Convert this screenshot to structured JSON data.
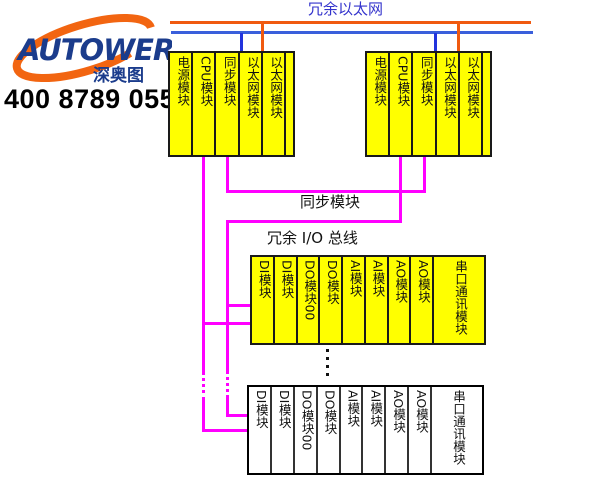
{
  "logo": {
    "brand": "AUTOWER",
    "cn_name": "深奥图",
    "phone": "400 8789 055"
  },
  "header": {
    "ethernet_label": "冗余以太网"
  },
  "links": {
    "sync_label": "同步模块",
    "io_bus_label": "冗余 I/O 总线"
  },
  "controller_rack": {
    "slots": [
      "电源模块",
      "CPU模块",
      "同步模块",
      "以太网模块",
      "以太网模块",
      ""
    ]
  },
  "io_rack": {
    "slots": [
      "DI模块",
      "DI模块",
      "DO模块00",
      "DO模块",
      "AI模块",
      "AI模块",
      "AO模块",
      "AO模块",
      "串口通讯模块"
    ]
  },
  "colors": {
    "ethernet_bus_orange": "#F05A10",
    "ethernet_bus_blue": "#3A5FDB",
    "sync_io_bus_magenta": "#FF00FF",
    "module_fill_yellow": "#FFFF00",
    "ethernet_label_blue": "#3333CC",
    "brand_navy": "#1B3C8C",
    "brand_orange": "#F26511"
  }
}
